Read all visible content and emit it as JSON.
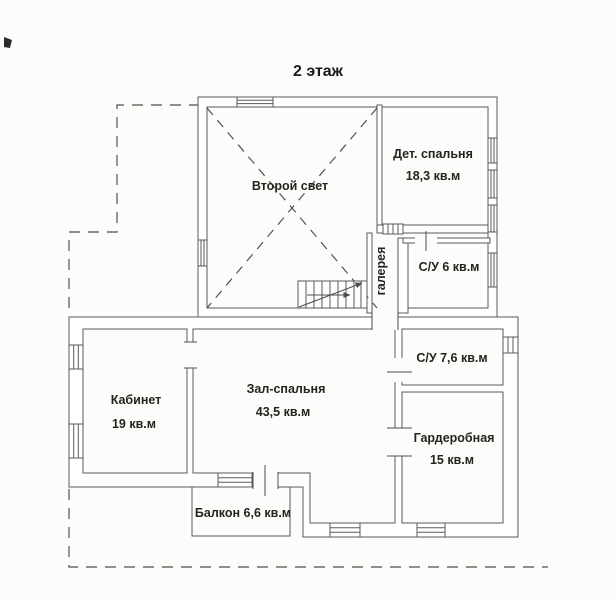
{
  "title": "2 этаж",
  "rooms": {
    "vtoroy_svet": {
      "name": "Второй свет"
    },
    "det_spalnya": {
      "name": "Дет. спальня",
      "area": "18,3 кв.м"
    },
    "galereya": {
      "name": "галерея"
    },
    "su_6": {
      "name": "С/У 6 кв.м"
    },
    "su_76": {
      "name": "С/У 7,6 кв.м"
    },
    "garderobnaya": {
      "name": "Гардеробная",
      "area": "15 кв.м"
    },
    "kabinet": {
      "name": "Кабинет",
      "area": "19 кв.м"
    },
    "zal_spalnya": {
      "name": "Зал-спальня",
      "area": "43,5 кв.м"
    },
    "balkon": {
      "name": "Балкон 6,6 кв.м"
    }
  },
  "colors": {
    "paper": "#fcfcfa",
    "wall": "#5a5a58",
    "text": "#26231f",
    "dashed_outline": "#6b6a66"
  }
}
